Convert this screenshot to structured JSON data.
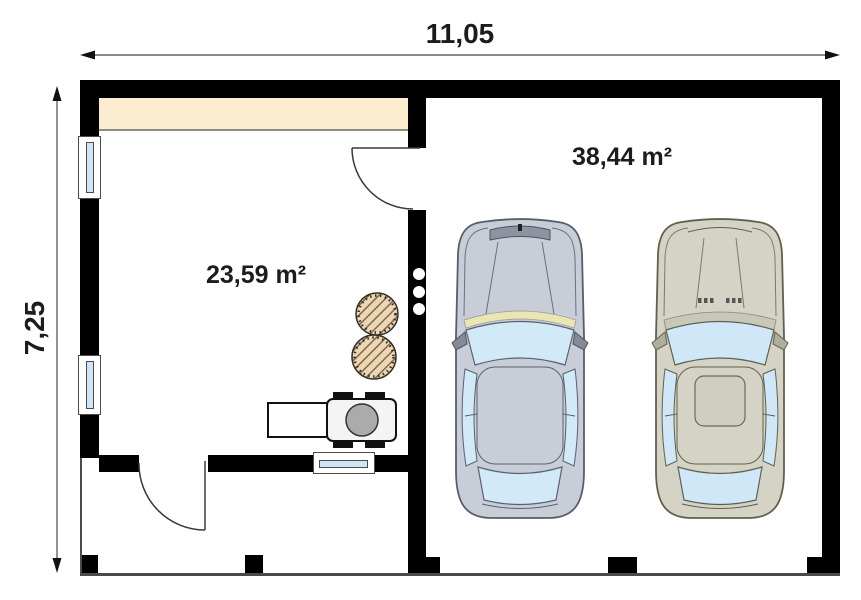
{
  "plan": {
    "width_label": "11,05",
    "height_label": "7,25",
    "rooms": [
      {
        "id": "room-1",
        "area_label": "23,59 m²"
      },
      {
        "id": "garage",
        "area_label": "38,44 m²"
      }
    ]
  },
  "objects": {
    "wardrobe_strip": "built-in wardrobe",
    "stools": "two round stools",
    "grill": "grill trolley",
    "car_left": "car top-view (gray)",
    "car_right": "car top-view (beige)"
  },
  "colors": {
    "wall": "#000000",
    "wardrobe": "#fcecd0",
    "window_glass": "#cfe4f4",
    "car_gray_body": "#c9cdd8",
    "car_gray_glass": "#d2e9f8",
    "car_beige_body": "#d5d3c5",
    "car_beige_glass": "#cfe7f7",
    "stool_fill": "#ead7b5",
    "grill_burner": "#ababab"
  }
}
